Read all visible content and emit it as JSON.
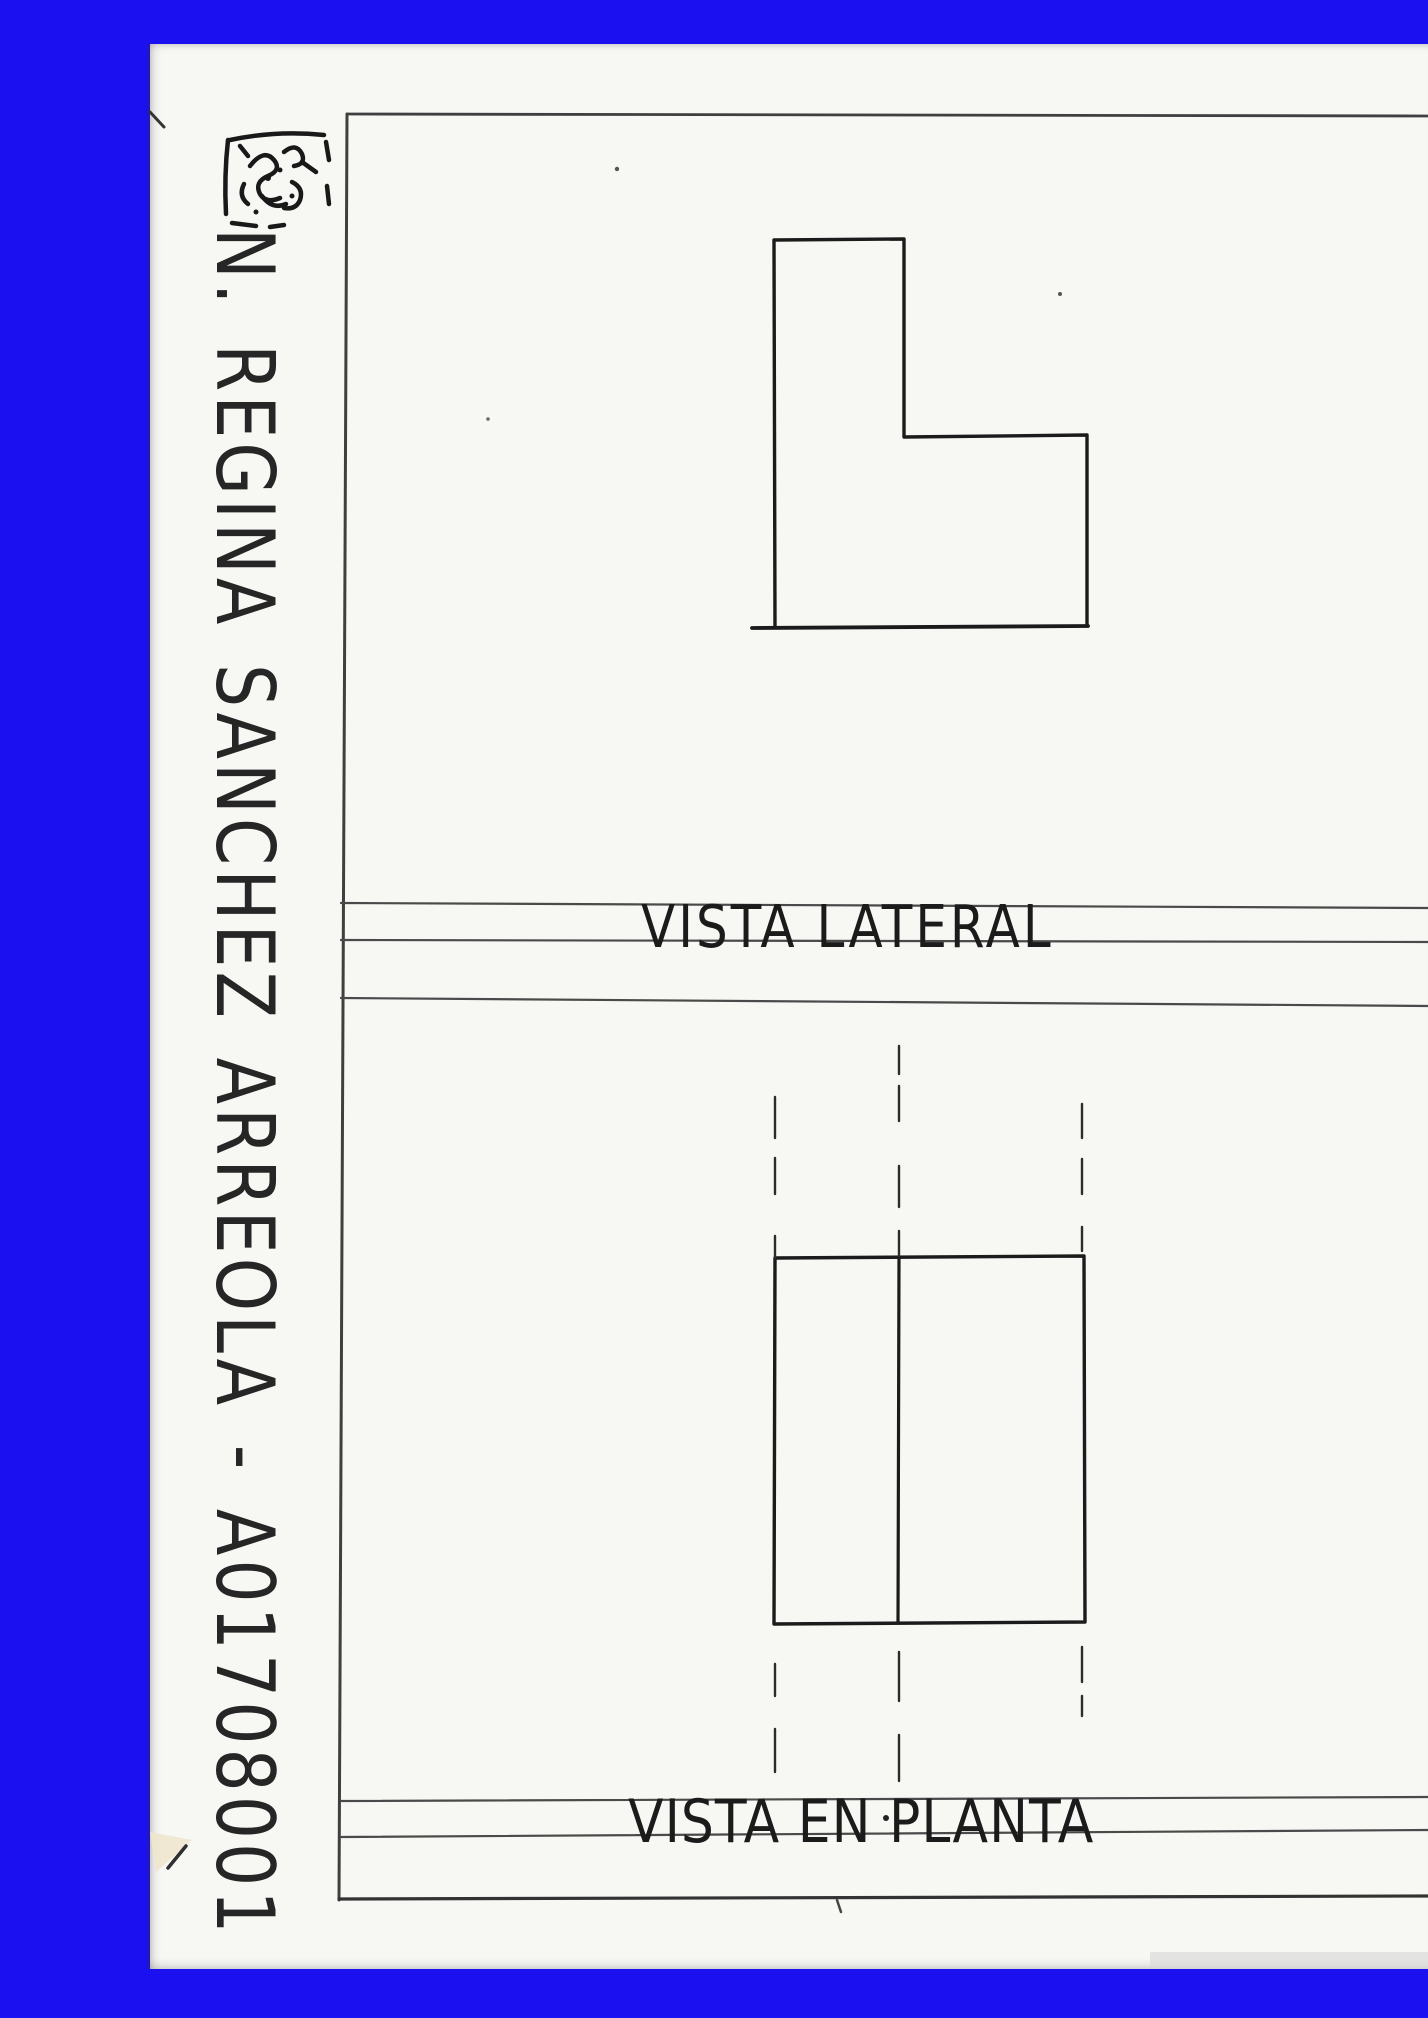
{
  "colors": {
    "background_blue": "#1b10f0",
    "paper": "#f7f7f4",
    "ink": "#1c1c1c",
    "pencil_line": "#4a4a4a"
  },
  "side_note": {
    "scribble": "crossed-out-scribble",
    "text": "N. REGINA SANCHEZ ARREOLA - A01708001"
  },
  "sections": {
    "lateral": {
      "label": "VISTA LATERAL"
    },
    "plan": {
      "label": "VISTA EN PLANTA"
    }
  }
}
